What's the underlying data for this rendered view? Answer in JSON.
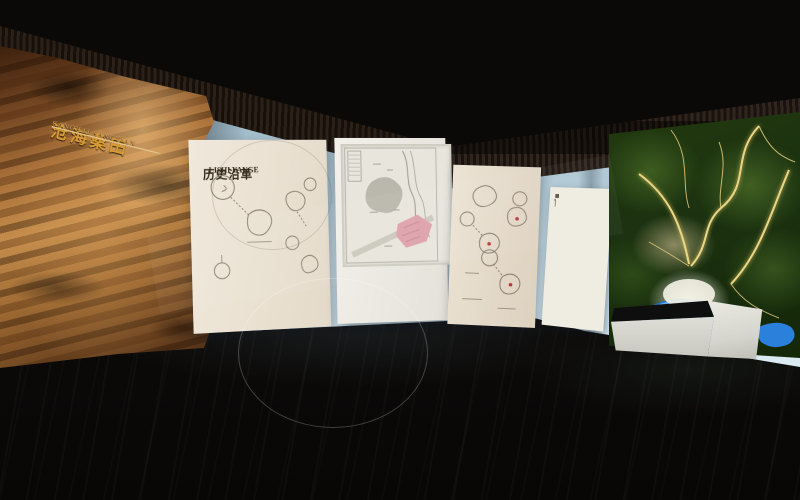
{
  "scene": {
    "name": "museum-exhibition-hall-render"
  },
  "palette": {
    "ceiling": "#0b0908",
    "wall_glow": "#cfe3ec",
    "rock_gold": "#d89a33",
    "panel_cream": "#ece3d6",
    "map_highlight_pink": "#dfa3ad",
    "terrain_green": "#22390f",
    "river_gold": "#ead687",
    "lake_blue": "#1f72cf",
    "floor_dark": "#0c0a09"
  },
  "rock_wall": {
    "title_cn": "沧海桑田",
    "title_en": "CANGHAI SANGTIAN",
    "inscription_line_count": 7
  },
  "history_panel": {
    "title_cn": "历史沿革",
    "title_en": "LISHI YANGE",
    "intro_line_count": 6
  },
  "map_board": {
    "caption_line_counts": [
      2,
      2,
      3
    ]
  },
  "chronology_panel": {
    "title_char_count": 6,
    "table": {
      "rows": 16,
      "cols": 4
    }
  }
}
